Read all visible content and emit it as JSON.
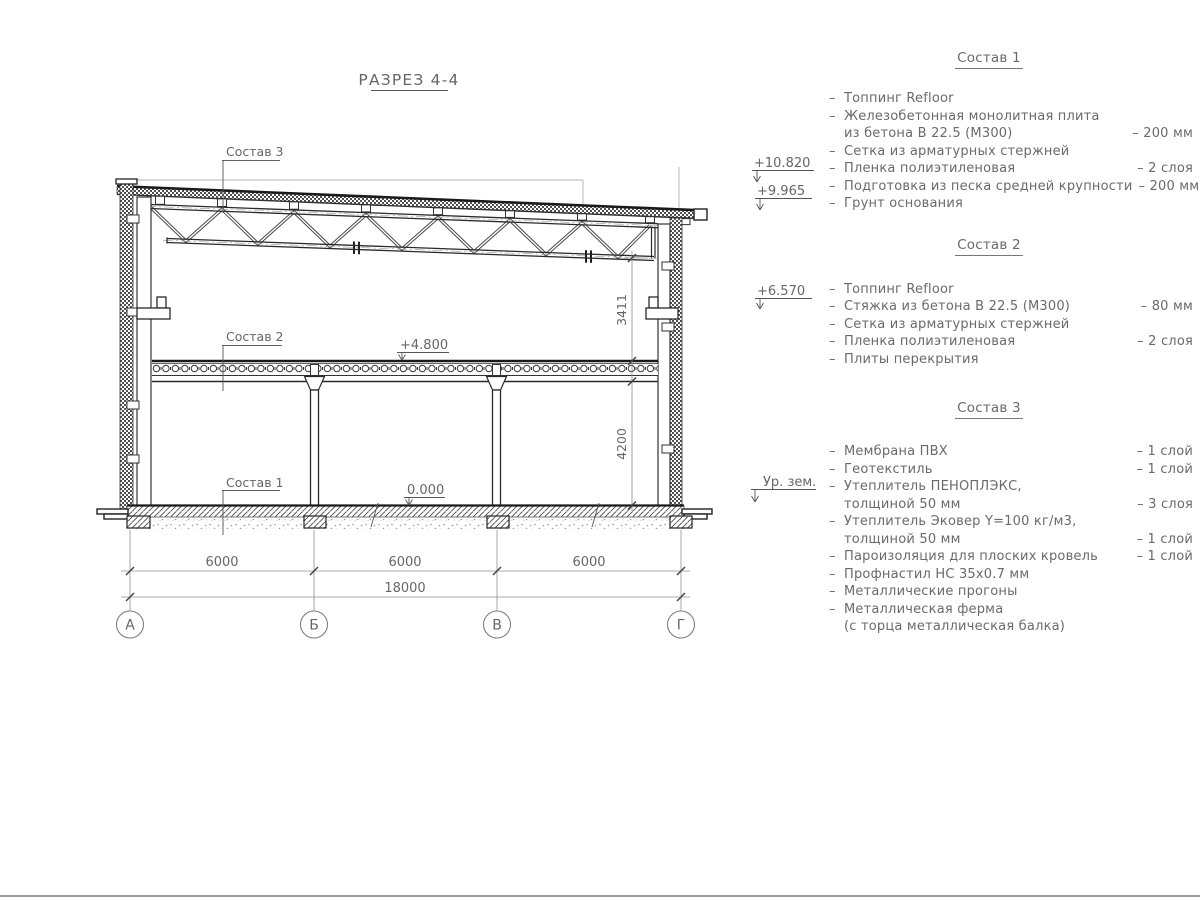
{
  "sheet": {
    "title": "РАЗРЕЗ 4-4"
  },
  "list_dash": "–",
  "drawing": {
    "callouts": {
      "sostav1": "Состав 1",
      "sostav2": "Состав 2",
      "sostav3": "Состав 3"
    },
    "elevations": {
      "parapet": "+10.820",
      "roof_edge": "+9.965",
      "crane": "+6.570",
      "ground_label": "Ур. зем.",
      "floor": "+4.800",
      "zero": "0.000"
    },
    "dimensions": {
      "truss_clearance": "3411",
      "floor_clearance": "4200",
      "bay1": "6000",
      "bay2": "6000",
      "bay3": "6000",
      "total": "18000"
    },
    "axes": [
      "А",
      "Б",
      "В",
      "Г"
    ]
  },
  "compositions": [
    {
      "title": "Состав 1",
      "items": [
        {
          "text": "Топпинг Refloor"
        },
        {
          "text": "Железобетонная  монолитная плита"
        },
        {
          "text": "из бетона В 22.5 (М300)",
          "value": "– 200 мм"
        },
        {
          "text": "Сетка из арматурных стержней"
        },
        {
          "text": "Пленка полиэтиленовая",
          "value": "– 2 слоя"
        },
        {
          "text": "Подготовка из песка средней крупности",
          "value": "– 200 мм"
        },
        {
          "text": "Грунт основания"
        }
      ]
    },
    {
      "title": "Состав 2",
      "items": [
        {
          "text": "Топпинг Refloor"
        },
        {
          "text": "Стяжка из бетона В 22.5 (М300)",
          "value": "– 80 мм"
        },
        {
          "text": "Сетка из арматурных стержней"
        },
        {
          "text": "Пленка полиэтиленовая",
          "value": "– 2 слоя"
        },
        {
          "text": "Плиты перекрытия"
        }
      ]
    },
    {
      "title": "Состав 3",
      "items": [
        {
          "text": "Мембрана ПВХ",
          "value": "– 1 слой"
        },
        {
          "text": "Геотекстиль",
          "value": "– 1 слой"
        },
        {
          "text": "Утеплитель ПЕНОПЛЭКС,"
        },
        {
          "text": "толщиной 50 мм",
          "value": "– 3 слоя"
        },
        {
          "text": "Утеплитель Эковер Y=100 кг/м3,"
        },
        {
          "text": "толщиной 50 мм",
          "value": "– 1 слой"
        },
        {
          "text": "Пароизоляция для плоских кровель",
          "value": "– 1 слой"
        },
        {
          "text": "Профнастил НС 35х0.7 мм"
        },
        {
          "text": "Металлические прогоны"
        },
        {
          "text": "Металлическая ферма"
        },
        {
          "text": "(с торца металлическая балка)"
        }
      ]
    }
  ]
}
